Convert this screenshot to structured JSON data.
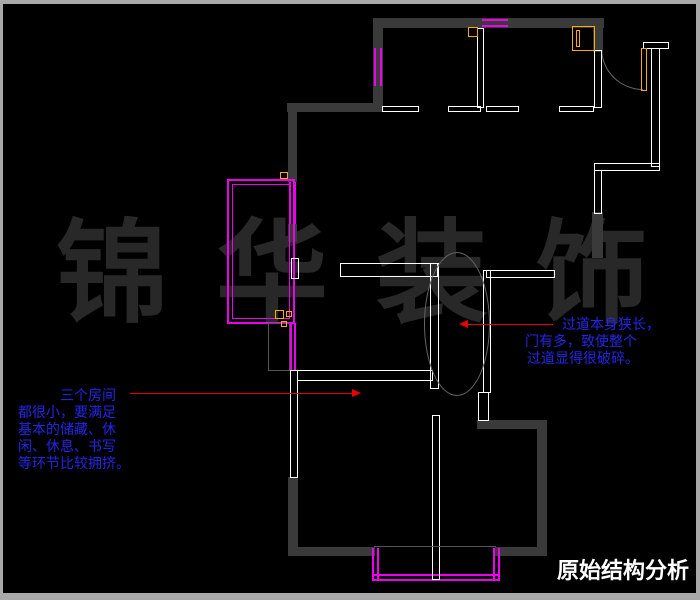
{
  "title": {
    "text": "原始结构分析"
  },
  "watermark": {
    "text": "锦华装饰"
  },
  "annotations": {
    "left": {
      "lines": [
        "三个房间",
        "都很小，要满足",
        "基本的储藏、休",
        "闲、休息、书写",
        "等环节比较拥挤。"
      ]
    },
    "right": {
      "lines": [
        "过道本身狭长，",
        "门有多，致使整个",
        "过道显得很破碎。"
      ]
    }
  },
  "colors": {
    "background": "#000000",
    "frame": "#a8a8a8",
    "wall": "#3a3a3a",
    "partition": "#ffffff",
    "magenta": "#ee00ee",
    "orange": "#ffaa00",
    "red": "#e80000",
    "blue": "#2424e8",
    "watermark": "#282828",
    "thin": "#555555",
    "title": "#ffffff"
  },
  "plan": {
    "segments": [
      [
        "wall",
        373,
        18,
        231,
        10
      ],
      [
        "wall",
        373,
        18,
        10,
        92
      ],
      [
        "wall",
        287,
        103,
        96,
        9
      ],
      [
        "wall",
        288,
        103,
        9,
        79
      ],
      [
        "wall",
        288,
        224,
        9,
        18
      ],
      [
        "wall",
        593,
        18,
        10,
        34
      ],
      [
        "wall",
        592,
        212,
        11,
        46
      ],
      [
        "wall",
        288,
        477,
        10,
        79
      ],
      [
        "wall",
        290,
        547,
        85,
        9
      ],
      [
        "wall",
        495,
        547,
        52,
        9
      ],
      [
        "wall",
        537,
        420,
        10,
        136
      ],
      [
        "wall",
        477,
        420,
        70,
        9
      ],
      [
        "mdouble-h",
        482,
        19,
        26,
        8,
        "window"
      ],
      [
        "mdouble-v",
        374,
        48,
        8,
        38,
        "window"
      ],
      [
        "m2rect",
        227,
        179,
        68,
        145,
        "balcony-window-outer"
      ],
      [
        "mrect",
        232,
        184,
        58,
        135,
        "balcony-window-inner"
      ],
      [
        "mdouble-v",
        289,
        182,
        7,
        42,
        "window"
      ],
      [
        "mdouble-v",
        290,
        323,
        6,
        48,
        "window"
      ],
      [
        "mdouble-v",
        372,
        548,
        7,
        33,
        "balcony-window"
      ],
      [
        "mdouble-v",
        493,
        548,
        7,
        33,
        "balcony-window"
      ],
      [
        "mdouble-h",
        372,
        574,
        128,
        7,
        "balcony-window"
      ],
      [
        "wrect",
        382,
        106,
        37,
        6
      ],
      [
        "wrect",
        448,
        106,
        33,
        6
      ],
      [
        "wrect",
        477,
        28,
        7,
        80
      ],
      [
        "wrect",
        486,
        106,
        33,
        6
      ],
      [
        "wrect",
        559,
        106,
        35,
        6
      ],
      [
        "wrect",
        594,
        50,
        8,
        58
      ],
      [
        "wrect",
        643,
        42,
        26,
        7
      ],
      [
        "wrect",
        651,
        48,
        9,
        119
      ],
      [
        "wrect",
        594,
        163,
        66,
        8
      ],
      [
        "wrect",
        594,
        170,
        8,
        44
      ],
      [
        "wrect",
        291,
        258,
        8,
        21
      ],
      [
        "wrect",
        340,
        263,
        98,
        14
      ],
      [
        "wrect",
        430,
        263,
        9,
        126
      ],
      [
        "wrect",
        297,
        370,
        136,
        11
      ],
      [
        "wrect",
        290,
        370,
        8,
        108
      ],
      [
        "wrect",
        483,
        270,
        8,
        123
      ],
      [
        "wrect",
        486,
        270,
        69,
        8
      ],
      [
        "wrect",
        432,
        415,
        8,
        165
      ],
      [
        "wrect",
        478,
        392,
        11,
        29
      ],
      [
        "gline",
        374,
        546,
        122,
        1,
        "balcony-threshold"
      ],
      [
        "grect",
        268,
        323,
        22,
        48,
        "door-panel"
      ],
      [
        "orect",
        468,
        27,
        10,
        10,
        "fixture"
      ],
      [
        "orect",
        572,
        26,
        23,
        25,
        "appliance"
      ],
      [
        "orect",
        576,
        30,
        4,
        17,
        "appliance-detail"
      ],
      [
        "orect",
        641,
        48,
        6,
        43,
        "entry-door-leaf"
      ],
      [
        "orect",
        280,
        172,
        8,
        7,
        "fixture"
      ],
      [
        "orect",
        275,
        310,
        9,
        9,
        "fixture"
      ],
      [
        "orect",
        286,
        311,
        6,
        6,
        "fixture"
      ],
      [
        "orect",
        281,
        321,
        6,
        6,
        "fixture"
      ]
    ]
  }
}
